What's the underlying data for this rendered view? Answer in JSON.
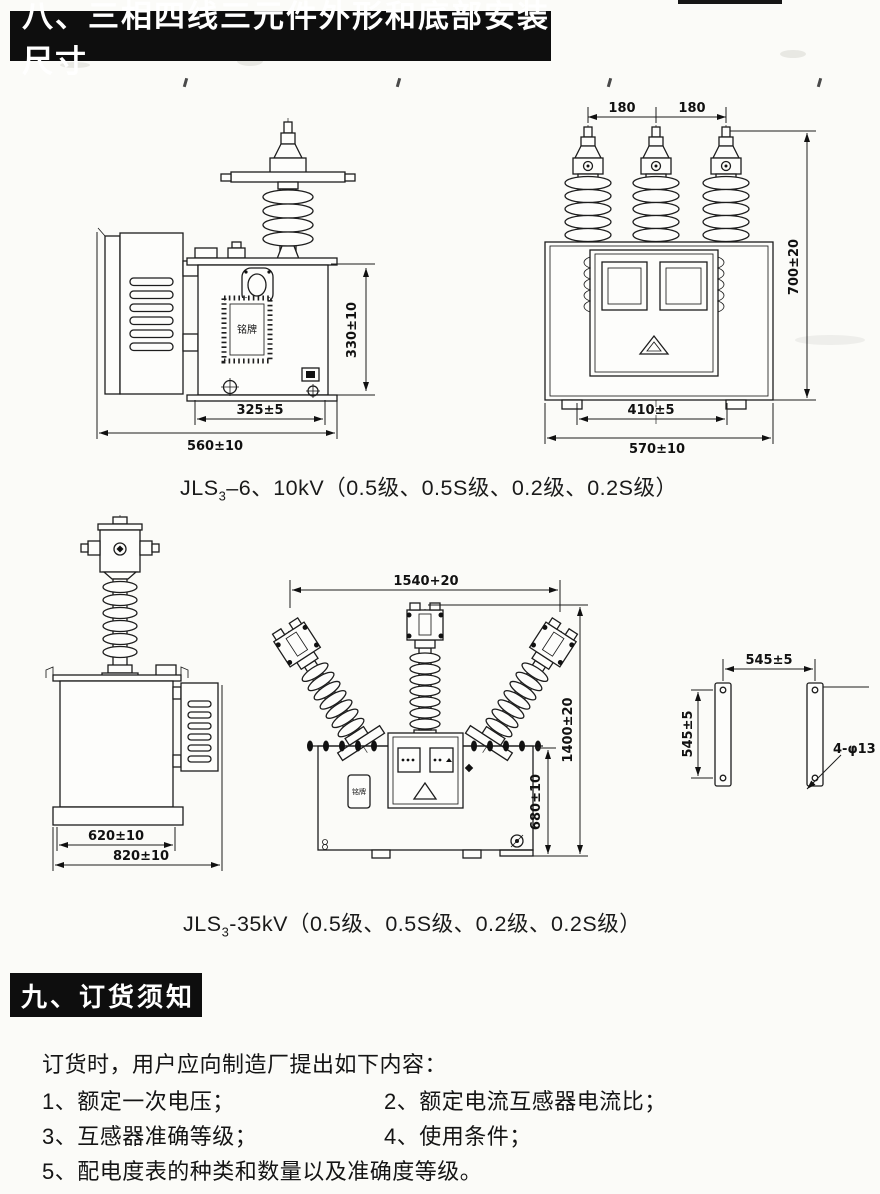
{
  "colors": {
    "ink": "#1d1d1d",
    "paper": "#fbfbf8",
    "bar": "#0e0e0e"
  },
  "section8": {
    "title": "八、三相四线三元件外形和底部安装尺寸"
  },
  "section9": {
    "title": "九、订货须知"
  },
  "figure1": {
    "caption": {
      "prefix": "JLS",
      "sub": "3",
      "rest": "–6、10kV（0.5级、0.5S级、0.2级、0.2S级）"
    },
    "side": {
      "nameplate": "铭牌",
      "dim_height": "330±10",
      "dim_base": "325±5",
      "dim_overall": "560±10"
    },
    "front": {
      "dim_pitch_left": "180",
      "dim_pitch_right": "180",
      "dim_height": "700±20",
      "dim_base": "410±5",
      "dim_overall": "570±10"
    }
  },
  "figure2": {
    "caption": {
      "prefix": "JLS",
      "sub": "3",
      "rest": "-35kV（0.5级、0.5S级、0.2级、0.2S级）"
    },
    "side": {
      "dim_base": "620±10",
      "dim_overall": "820±10"
    },
    "front": {
      "nameplate": "铭牌",
      "dim_width": "1540+20",
      "dim_height": "1400±20",
      "dim_tank_height": "680±10"
    },
    "mount": {
      "dim_span": "545±5",
      "dim_pitch": "545±5",
      "dim_holes": "4-φ13"
    }
  },
  "order": {
    "intro": "订货时，用户应向制造厂提出如下内容：",
    "items": [
      "1、额定一次电压；",
      "2、额定电流互感器电流比；",
      "3、互感器准确等级；",
      "4、使用条件；",
      "5、配电度表的种类和数量以及准确度等级。"
    ]
  }
}
